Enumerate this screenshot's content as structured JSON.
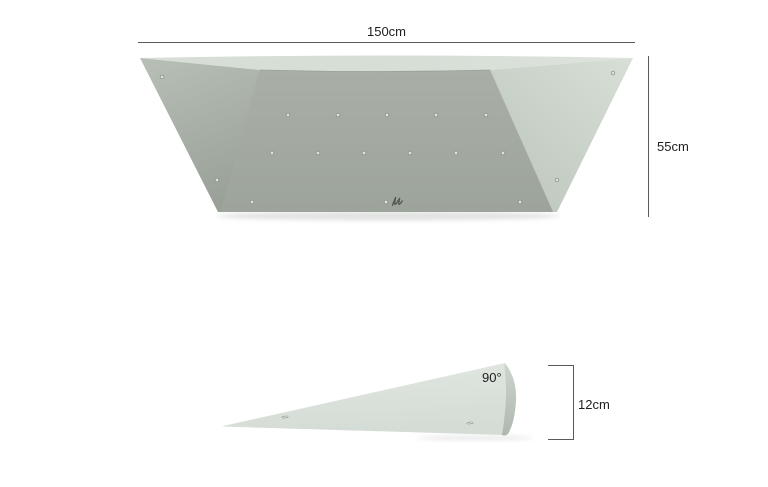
{
  "title": "Climbing volume dimension drawing",
  "labels": {
    "front_width": "150cm",
    "front_height": "55cm",
    "side_angle": "90°",
    "side_height": "12cm"
  },
  "colors": {
    "background": "#ffffff",
    "dim_line": "#5a5a5a",
    "text": "#1e1e1e",
    "top_band": "#d6ded6",
    "top_band_edge": "#dde3dc",
    "left_face_top": "#b6beb5",
    "left_face_bottom": "#99a098",
    "front_face_top": "#a9afa7",
    "front_face_bottom": "#9da49b",
    "right_face_top": "#d7dfd6",
    "right_face_bottom": "#bec7bd",
    "seam": "#8f968e",
    "wedge_top": "#e1e7e1",
    "wedge_bottom": "#d4dcd5",
    "cap_top": "#ccd5cc",
    "cap_bottom": "#aeb8af",
    "hole_fill": "#e0e4df",
    "hole_rim": "#7e857c",
    "logo": "#54574f",
    "shadow": "#c4c6c4"
  },
  "front_view": {
    "description": "Front view of trapezoidal climbing volume",
    "side_face_holes": [
      [
        162,
        77
      ],
      [
        217,
        180
      ],
      [
        613,
        73
      ],
      [
        557,
        180
      ]
    ],
    "front_face_hole_rows": [
      {
        "y": 115,
        "xs": [
          288,
          338,
          387,
          436,
          486
        ]
      },
      {
        "y": 153,
        "xs": [
          272,
          318,
          364,
          410,
          456,
          503
        ]
      },
      {
        "y": 202,
        "xs": [
          252,
          386,
          520
        ]
      }
    ]
  },
  "side_view": {
    "description": "Side profile wedge, 90 degree back, 12cm tall",
    "slots": [
      [
        285,
        417
      ],
      [
        470,
        423
      ]
    ]
  }
}
